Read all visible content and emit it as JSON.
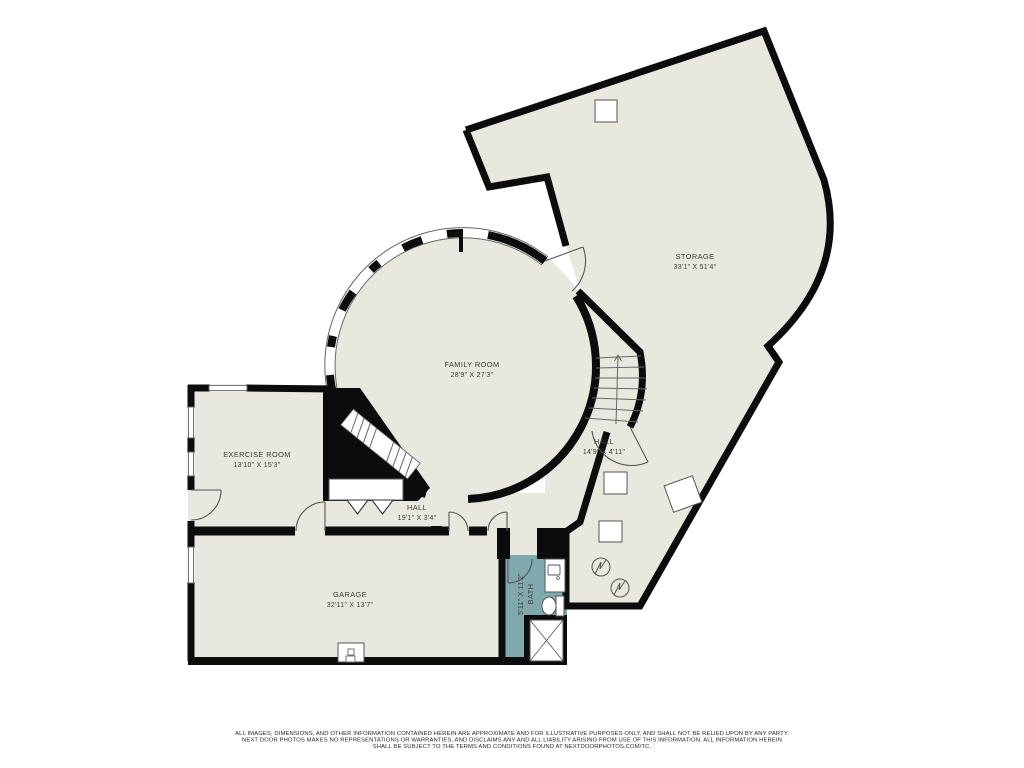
{
  "floorplan": {
    "rooms": {
      "storage": {
        "name": "STORAGE",
        "dims": "33'1\" X 51'4\""
      },
      "family_room": {
        "name": "FAMILY ROOM",
        "dims": "28'9\" X 27'3\""
      },
      "exercise_room": {
        "name": "EXERCISE ROOM",
        "dims": "13'10\" X 15'3\""
      },
      "hall_lower": {
        "name": "HALL",
        "dims": "19'1\" X 3'4\""
      },
      "hall_right": {
        "name": "HALL",
        "dims": "14'9\" X 4'11\""
      },
      "garage": {
        "name": "GARAGE",
        "dims": "32'11\" X 13'7\""
      },
      "bath": {
        "name": "BATH",
        "dims": "5'11\" X 11'2\""
      }
    },
    "colors": {
      "floor": "#e9e8df",
      "wall": "#0c0c0c",
      "bath_floor": "#7fa9ad",
      "background": "#ffffff"
    },
    "disclaimer": {
      "line1": "ALL IMAGES, DIMENSIONS, AND OTHER INFORMATION CONTAINED HEREIN ARE APPROXIMATE AND FOR ILLUSTRATIVE PURPOSES ONLY, AND SHALL NOT BE RELIED UPON BY ANY PARTY.",
      "line2": "NEXT DOOR PHOTOS MAKES NO REPRESENTATIONS OR WARRANTIES, AND DISCLAIMS ANY AND ALL LIABILITY ARISING FROM USE OF THIS INFORMATION. ALL INFORMATION HEREIN",
      "line3": "SHALL BE SUBJECT TO THE TERMS AND CONDITIONS FOUND AT NEXTDOORPHOTOS.COM/TC."
    }
  }
}
